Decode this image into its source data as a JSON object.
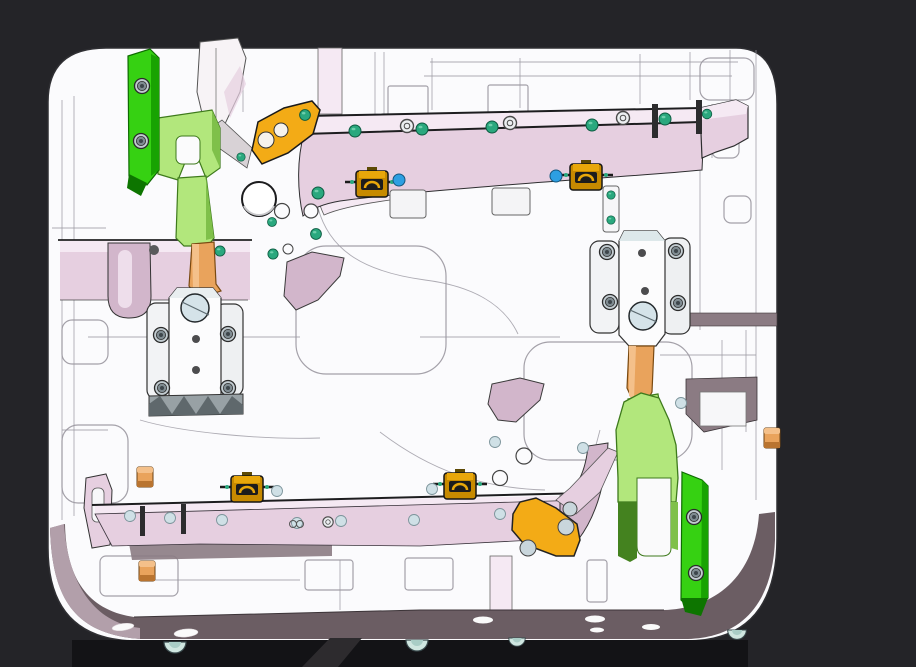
{
  "scene": {
    "type": "3d-cad-assembly-view",
    "subject": "injection-mold-base-plate-with-clamps",
    "projection": "isometric-front",
    "visible_text": ""
  },
  "canvas": {
    "width": 916,
    "height": 667,
    "background": "#242428"
  },
  "colors": {
    "bg": "#242428",
    "under": "#131316",
    "plate_white": "#fbfbfd",
    "outline": "#2f2f33",
    "linegray": "#9a97a0",
    "pink_light": "#f5e9f3",
    "pink_mid": "#e6cfe0",
    "pink_deep": "#d2b6cb",
    "mauve": "#6b5d63",
    "mauve_light": "#b29faa",
    "mauve_soft": "#8b7b83",
    "green_bright": "#36d112",
    "green_bright_dark": "#18a302",
    "green_deep": "#0d7500",
    "green_light": "#b2e77c",
    "green_light_dark": "#7fc04a",
    "green_edge": "#3e7a1c",
    "green_shadow": "#44821f",
    "orange": "#e9a35c",
    "orange_light": "#f4c08a",
    "orange_dark": "#b97430",
    "yellow": "#f3ab16",
    "brass": "#c78a00",
    "brass_mid": "#e8a70a",
    "brass_dark": "#5d4a05",
    "teal_dot": "#2aa87e",
    "blue_dot": "#2d9fe2",
    "pale_dot": "#cfe0e6",
    "bolt_ring": "#c2ccd1",
    "bolt_inner": "#7f8b91",
    "glass": "#d5e3e9",
    "teeth": "#98a1a5",
    "teeth_dark": "#5f686c",
    "leg": "#2d2b2e",
    "foot": "#cfe6e0",
    "hole_gray": "#c9d6dc"
  },
  "parts": [
    {
      "name": "mold-base-plate",
      "color": "plate_white"
    },
    {
      "name": "top-core-rail",
      "color": "pink_mid"
    },
    {
      "name": "bottom-core-rail",
      "color": "pink_mid"
    },
    {
      "name": "green-clamp-bar-top-left",
      "color": "green_bright"
    },
    {
      "name": "green-clamp-arm-top-left",
      "color": "green_light"
    },
    {
      "name": "slide-lock-unit-left",
      "color": "plate_white"
    },
    {
      "name": "slide-lock-unit-right",
      "color": "plate_white"
    },
    {
      "name": "green-clamp-arm-bottom-right",
      "color": "green_light"
    },
    {
      "name": "green-clamp-bar-bottom-right",
      "color": "green_bright"
    },
    {
      "name": "yellow-wedge-plate-top",
      "color": "yellow"
    },
    {
      "name": "yellow-wedge-plate-bottom",
      "color": "yellow"
    },
    {
      "name": "toggle-clamp-top-left",
      "color": "brass"
    },
    {
      "name": "toggle-clamp-top-right",
      "color": "brass"
    },
    {
      "name": "toggle-clamp-bottom-left",
      "color": "brass"
    },
    {
      "name": "toggle-clamp-bottom-right",
      "color": "brass"
    },
    {
      "name": "locator-sphere",
      "color": "plate_white"
    },
    {
      "name": "orange-wear-plugs",
      "color": "orange"
    },
    {
      "name": "support-leg",
      "color": "leg"
    },
    {
      "name": "bottom-face-band",
      "color": "mauve"
    }
  ],
  "markers": {
    "teal_screw_dots": 18,
    "blue_pins": 2,
    "pale_pin_dots": 12,
    "inspection_circles": 2,
    "toggle_clamps": 4,
    "bottom_face_slots": 6,
    "foot_domes": 4
  }
}
